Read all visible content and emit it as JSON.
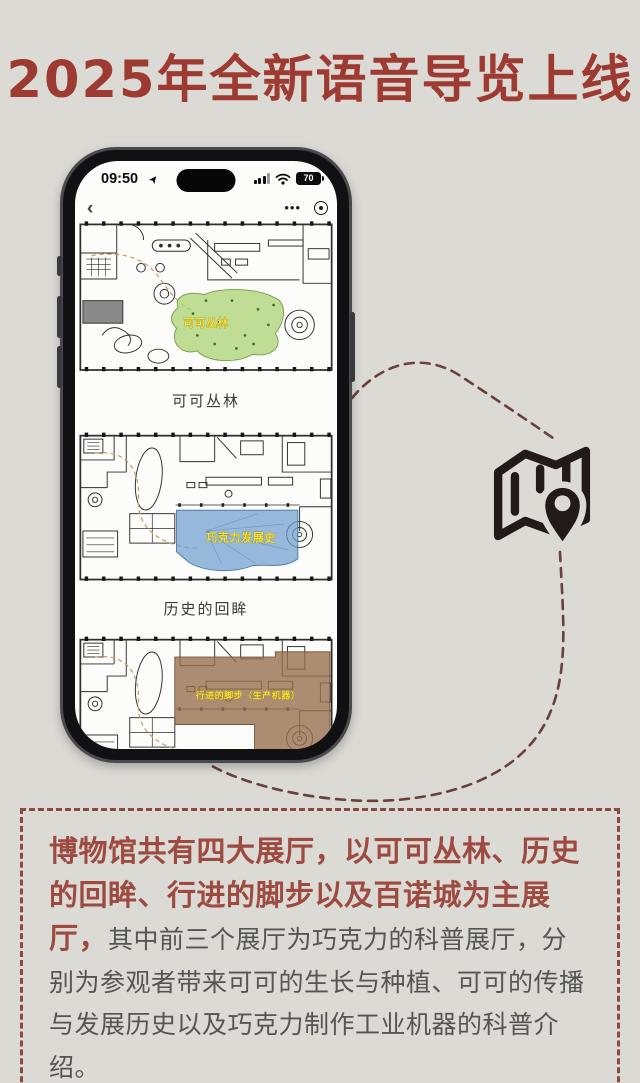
{
  "page": {
    "title": "2025年全新语音导览上线",
    "title_color": "#9d3a31",
    "background_color": "#dcdad5"
  },
  "phone": {
    "status_bar": {
      "time": "09:50",
      "battery_level": "70"
    },
    "nav": {
      "back_label": "‹",
      "more_dots": "•••"
    },
    "halls": [
      {
        "label": "可可丛林",
        "overlay_label": "可可丛林",
        "highlight_color": "#aed479"
      },
      {
        "label": "历史的回眸",
        "overlay_label": "巧克力发展史",
        "highlight_color": "#6d9ecf"
      },
      {
        "overlay_label": "行进的脚步（生产机器）",
        "highlight_color": "#97704f"
      }
    ]
  },
  "map_icon": {
    "name": "folded-map-with-location-pin",
    "color": "#221a18"
  },
  "connector": {
    "color": "#6a403a",
    "style": "dashed"
  },
  "description": {
    "highlight_text": "博物馆共有四大展厅，以可可丛林、历史的回眸、行进的脚步以及百诺城为主展厅，",
    "body_text": "其中前三个展厅为巧克力的科普展厅，分别为参观者带来可可的生长与种植、可可的传播与发展历史以及巧克力制作工业机器的科普介绍。",
    "highlight_color": "#9d4a40",
    "body_color": "#555555",
    "border_color": "#8a4a41"
  }
}
